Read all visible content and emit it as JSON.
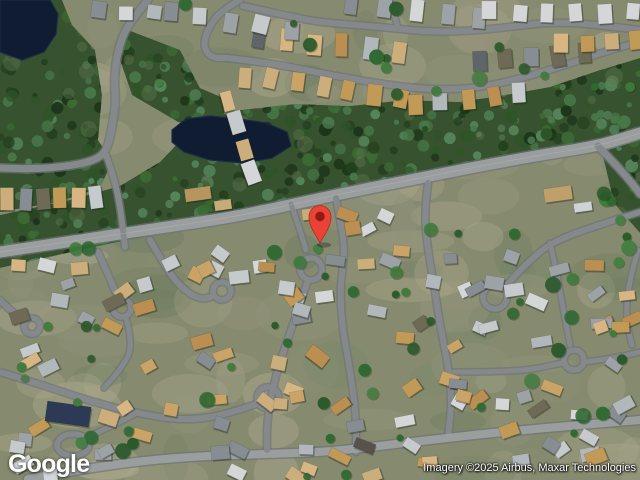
{
  "overlay": {
    "logo": "Google",
    "attribution": "Imagery ©2025 Airbus, Maxar Technologies"
  },
  "map": {
    "width": 640,
    "height": 480,
    "colors": {
      "ground": "#868b6f",
      "forest": "#36522e",
      "pond": "#0f1c31",
      "pond_edge": "#1b2b47",
      "road": "#85898b",
      "road_main": "#9a9e9f",
      "road_casing": "#6f7477",
      "road_centerline": "#c2c5c6",
      "house_shadow": "#1c2616",
      "mottle": [
        "#9c9a80",
        "#a8a68c",
        "#7c876b",
        "#b1ab90",
        "#6f7d61",
        "#90937a"
      ],
      "forest_trees": [
        "#24401f",
        "#2e5428",
        "#3c6b34",
        "#48784a",
        "#1d3519",
        "#55855b"
      ],
      "forest_clearing": "#5f7350",
      "scatter_trees": [
        "#2e6a31",
        "#3f7d3b",
        "#2a5a2b",
        "#477f44"
      ],
      "roof_gray": [
        "#c6cacd",
        "#b2b7bb",
        "#9da2a6",
        "#d4d6d8",
        "#878d92"
      ],
      "roof_tan": [
        "#caa466",
        "#d7b684",
        "#ba8f51",
        "#ccae7c",
        "#c19a58"
      ],
      "roof_dark": [
        "#5f656b",
        "#6e6a55",
        "#57534a"
      ]
    },
    "ponds": [
      [
        [
          0,
          0
        ],
        [
          50,
          0
        ],
        [
          58,
          14
        ],
        [
          56,
          34
        ],
        [
          44,
          52
        ],
        [
          22,
          60
        ],
        [
          0,
          52
        ]
      ],
      [
        [
          172,
          130
        ],
        [
          186,
          119
        ],
        [
          210,
          116
        ],
        [
          240,
          119
        ],
        [
          266,
          123
        ],
        [
          287,
          132
        ],
        [
          291,
          146
        ],
        [
          272,
          158
        ],
        [
          243,
          163
        ],
        [
          210,
          160
        ],
        [
          184,
          152
        ],
        [
          172,
          142
        ]
      ]
    ],
    "forest": [
      [
        [
          0,
          0
        ],
        [
          62,
          0
        ],
        [
          72,
          25
        ],
        [
          95,
          50
        ],
        [
          102,
          95
        ],
        [
          98,
          140
        ],
        [
          112,
          162
        ],
        [
          100,
          188
        ],
        [
          58,
          202
        ],
        [
          0,
          212
        ]
      ],
      [
        [
          0,
          215
        ],
        [
          70,
          200
        ],
        [
          120,
          186
        ],
        [
          160,
          162
        ],
        [
          200,
          120
        ],
        [
          240,
          110
        ],
        [
          295,
          104
        ],
        [
          350,
          106
        ],
        [
          405,
          100
        ],
        [
          460,
          102
        ],
        [
          505,
          95
        ],
        [
          550,
          87
        ],
        [
          600,
          70
        ],
        [
          640,
          58
        ],
        [
          640,
          128
        ],
        [
          560,
          150
        ],
        [
          470,
          170
        ],
        [
          380,
          186
        ],
        [
          300,
          201
        ],
        [
          240,
          217
        ],
        [
          160,
          233
        ],
        [
          80,
          250
        ],
        [
          0,
          268
        ]
      ],
      [
        [
          128,
          30
        ],
        [
          180,
          50
        ],
        [
          200,
          88
        ],
        [
          228,
          100
        ],
        [
          218,
          132
        ],
        [
          178,
          122
        ],
        [
          132,
          95
        ],
        [
          120,
          60
        ]
      ],
      [
        [
          602,
          152
        ],
        [
          640,
          140
        ],
        [
          640,
          233
        ],
        [
          614,
          203
        ]
      ]
    ],
    "roads": [
      {
        "p": [
          [
            0,
            252
          ],
          [
            80,
            240
          ],
          [
            160,
            228
          ],
          [
            240,
            216
          ],
          [
            330,
            196
          ],
          [
            420,
            178
          ],
          [
            470,
            168
          ],
          [
            540,
            155
          ],
          [
            598,
            146
          ],
          [
            640,
            133
          ]
        ],
        "w": 11,
        "main": true
      },
      {
        "p": [
          [
            598,
            146
          ],
          [
            616,
            165
          ],
          [
            632,
            183
          ],
          [
            640,
            194
          ]
        ],
        "w": 7
      },
      {
        "p": [
          [
            148,
            0
          ],
          [
            138,
            12
          ],
          [
            124,
            32
          ],
          [
            117,
            55
          ],
          [
            114,
            80
          ],
          [
            116,
            102
          ],
          [
            112,
            128
          ],
          [
            107,
            150
          ],
          [
            96,
            160
          ],
          [
            70,
            166
          ],
          [
            35,
            169
          ],
          [
            0,
            168
          ]
        ],
        "w": 7
      },
      {
        "p": [
          [
            106,
            155
          ],
          [
            115,
            180
          ],
          [
            121,
            212
          ],
          [
            125,
            247
          ]
        ],
        "w": 6
      },
      {
        "p": [
          [
            240,
            0
          ],
          [
            221,
            11
          ],
          [
            208,
            28
          ],
          [
            203,
            46
          ],
          [
            211,
            58
          ],
          [
            228,
            58
          ]
        ],
        "w": 6
      },
      {
        "p": [
          [
            228,
            58
          ],
          [
            270,
            63
          ],
          [
            320,
            73
          ],
          [
            375,
            83
          ],
          [
            430,
            90
          ],
          [
            480,
            88
          ],
          [
            530,
            76
          ],
          [
            575,
            62
          ],
          [
            610,
            50
          ],
          [
            640,
            42
          ]
        ],
        "w": 6
      },
      {
        "p": [
          [
            243,
            6
          ],
          [
            280,
            14
          ],
          [
            317,
            22
          ],
          [
            357,
            25
          ],
          [
            391,
            28
          ],
          [
            430,
            32
          ],
          [
            470,
            31
          ],
          [
            510,
            27
          ],
          [
            550,
            22
          ],
          [
            590,
            24
          ],
          [
            640,
            30
          ]
        ],
        "w": 6
      },
      {
        "p": [
          [
            389,
            0
          ],
          [
            394,
            14
          ],
          [
            398,
            28
          ]
        ],
        "w": 5
      },
      {
        "p": [
          [
            291,
            204
          ],
          [
            299,
            227
          ],
          [
            306,
            250
          ]
        ],
        "w": 5
      },
      {
        "p": [
          [
            336,
            198
          ],
          [
            341,
            224
          ],
          [
            345,
            252
          ],
          [
            340,
            287
          ],
          [
            342,
            326
          ],
          [
            350,
            370
          ],
          [
            356,
            414
          ],
          [
            356,
            452
          ]
        ],
        "w": 6
      },
      {
        "p": [
          [
            428,
            183
          ],
          [
            424,
            215
          ],
          [
            428,
            250
          ],
          [
            434,
            285
          ],
          [
            440,
            325
          ],
          [
            448,
            365
          ],
          [
            452,
            400
          ],
          [
            448,
            437
          ]
        ],
        "w": 6
      },
      {
        "p": [
          [
            640,
            212
          ],
          [
            592,
            227
          ],
          [
            550,
            243
          ],
          [
            524,
            266
          ],
          [
            505,
            287
          ]
        ],
        "w": 6
      },
      {
        "p": [
          [
            550,
            243
          ],
          [
            557,
            274
          ],
          [
            563,
            308
          ],
          [
            570,
            345
          ]
        ],
        "w": 5
      },
      {
        "p": [
          [
            585,
            362
          ],
          [
            614,
            358
          ],
          [
            640,
            352
          ]
        ],
        "w": 5
      },
      {
        "p": [
          [
            28,
            479
          ],
          [
            100,
            466
          ],
          [
            180,
            457
          ],
          [
            260,
            454
          ],
          [
            330,
            452
          ],
          [
            420,
            441
          ],
          [
            510,
            431
          ],
          [
            640,
            420
          ]
        ],
        "w": 8,
        "main": true
      },
      {
        "p": [
          [
            150,
            240
          ],
          [
            163,
            263
          ],
          [
            180,
            287
          ],
          [
            200,
            300
          ],
          [
            214,
            296
          ]
        ],
        "w": 6
      },
      {
        "p": [
          [
            98,
            252
          ],
          [
            108,
            274
          ],
          [
            118,
            298
          ]
        ],
        "w": 6
      },
      {
        "p": [
          [
            0,
            300
          ],
          [
            12,
            312
          ],
          [
            24,
            320
          ]
        ],
        "w": 6
      },
      {
        "p": [
          [
            308,
            280
          ],
          [
            296,
            316
          ],
          [
            283,
            352
          ],
          [
            272,
            390
          ],
          [
            267,
            422
          ],
          [
            267,
            450
          ]
        ],
        "w": 6
      },
      {
        "p": [
          [
            267,
            400
          ],
          [
            230,
            414
          ],
          [
            185,
            421
          ],
          [
            135,
            413
          ],
          [
            90,
            401
          ],
          [
            48,
            387
          ],
          [
            0,
            372
          ]
        ],
        "w": 6
      },
      {
        "p": [
          [
            126,
            318
          ],
          [
            134,
            346
          ],
          [
            120,
            370
          ],
          [
            104,
            388
          ]
        ],
        "w": 5
      },
      {
        "p": [
          [
            90,
            436
          ],
          [
            112,
            426
          ],
          [
            135,
            414
          ]
        ],
        "w": 5
      },
      {
        "p": [
          [
            452,
            372
          ],
          [
            490,
            372
          ],
          [
            530,
            370
          ],
          [
            562,
            363
          ]
        ],
        "w": 5
      },
      {
        "p": [
          [
            638,
            250
          ],
          [
            628,
            285
          ],
          [
            626,
            320
          ],
          [
            632,
            345
          ]
        ],
        "w": 5
      }
    ],
    "loops": [
      {
        "x": 311,
        "y": 269,
        "r": 11
      },
      {
        "x": 495,
        "y": 297,
        "r": 12
      },
      {
        "x": 574,
        "y": 360,
        "r": 10
      },
      {
        "x": 222,
        "y": 291,
        "r": 9
      },
      {
        "x": 122,
        "y": 308,
        "r": 9
      },
      {
        "x": 32,
        "y": 326,
        "r": 8
      },
      {
        "x": 268,
        "y": 398,
        "r": 11
      },
      {
        "x": 73,
        "y": 445,
        "r": 16,
        "ry": 11
      }
    ],
    "house_rows": [
      {
        "a": [
          350,
          6
        ],
        "b": [
          480,
          16
        ],
        "n": 5,
        "w": 13,
        "h": 20,
        "pal": "gray"
      },
      {
        "a": [
          490,
          11
        ],
        "b": [
          635,
          13
        ],
        "n": 6,
        "w": 13,
        "h": 18,
        "pal": "gray"
      },
      {
        "a": [
          258,
          38
        ],
        "b": [
          398,
          52
        ],
        "n": 6,
        "w": 13,
        "h": 22,
        "pal": "mix"
      },
      {
        "a": [
          480,
          62
        ],
        "b": [
          585,
          54
        ],
        "n": 5,
        "w": 13,
        "h": 20,
        "pal": "dark"
      },
      {
        "a": [
          562,
          44
        ],
        "b": [
          635,
          41
        ],
        "n": 4,
        "w": 13,
        "h": 18,
        "pal": "tan"
      },
      {
        "a": [
          245,
          76
        ],
        "b": [
          400,
          99
        ],
        "n": 7,
        "w": 13,
        "h": 20,
        "pal": "tan"
      },
      {
        "a": [
          415,
          103
        ],
        "b": [
          520,
          93
        ],
        "n": 5,
        "w": 13,
        "h": 19,
        "pal": "mix"
      },
      {
        "a": [
          170,
          12
        ],
        "b": [
          290,
          30
        ],
        "n": 5,
        "w": 14,
        "h": 18,
        "pal": "gray"
      },
      {
        "a": [
          100,
          9
        ],
        "b": [
          155,
          14
        ],
        "n": 3,
        "w": 13,
        "h": 15,
        "pal": "gray"
      },
      {
        "a": [
          8,
          199
        ],
        "b": [
          96,
          196
        ],
        "n": 6,
        "w": 12,
        "h": 22,
        "pal": "mix"
      },
      {
        "a": [
          228,
          100
        ],
        "b": [
          252,
          172
        ],
        "n": 4,
        "w": 21,
        "h": 13,
        "pal": "mix"
      }
    ],
    "buildings": [
      {
        "x": 198,
        "y": 194,
        "w": 26,
        "h": 13,
        "r": -8,
        "c": "#b6955f"
      },
      {
        "x": 223,
        "y": 205,
        "w": 17,
        "h": 10,
        "r": -8,
        "c": "#c7ab79"
      },
      {
        "x": 558,
        "y": 194,
        "w": 28,
        "h": 14,
        "r": -8,
        "c": "#bfa06a"
      },
      {
        "x": 583,
        "y": 207,
        "w": 18,
        "h": 9,
        "r": -8,
        "c": "#d0d3d5"
      },
      {
        "x": 312,
        "y": 214,
        "w": 20,
        "h": 11,
        "r": -6,
        "c": "#c9ad77"
      },
      {
        "x": 68,
        "y": 414,
        "w": 44,
        "h": 20,
        "r": 8,
        "c": "#2c3a55"
      }
    ],
    "clusters": [
      {
        "b": [
          2,
          262,
          150,
          76
        ],
        "n": 12
      },
      {
        "b": [
          158,
          248,
          170,
          96
        ],
        "n": 15
      },
      {
        "b": [
          335,
          212,
          60,
          32
        ],
        "n": 4
      },
      {
        "b": [
          332,
          246,
          186,
          108
        ],
        "n": 17
      },
      {
        "b": [
          524,
          238,
          112,
          118
        ],
        "n": 11
      },
      {
        "b": [
          2,
          342,
          154,
          124
        ],
        "n": 13
      },
      {
        "b": [
          160,
          348,
          168,
          104
        ],
        "n": 13
      },
      {
        "b": [
          332,
          358,
          186,
          92
        ],
        "n": 13
      },
      {
        "b": [
          524,
          360,
          112,
          66
        ],
        "n": 7
      },
      {
        "b": [
          10,
          452,
          330,
          26
        ],
        "n": 6
      },
      {
        "b": [
          345,
          448,
          120,
          30
        ],
        "n": 3
      },
      {
        "b": [
          470,
          432,
          168,
          46
        ],
        "n": 6
      }
    ],
    "tree_scatter": [
      {
        "b": [
          0,
          228,
          640,
          252
        ],
        "n": 52
      },
      {
        "b": [
          150,
          0,
          300,
          105
        ],
        "n": 10
      },
      {
        "b": [
          470,
          30,
          170,
          60
        ],
        "n": 6
      },
      {
        "b": [
          600,
          190,
          40,
          120
        ],
        "n": 6
      }
    ],
    "marker": {
      "x": 320,
      "y": 243,
      "head_y": 216.5,
      "head_r": 11,
      "dot_r": 4.7,
      "color": "#EA4335",
      "stroke": "#B3281E",
      "dot": "#8E1B10"
    }
  }
}
